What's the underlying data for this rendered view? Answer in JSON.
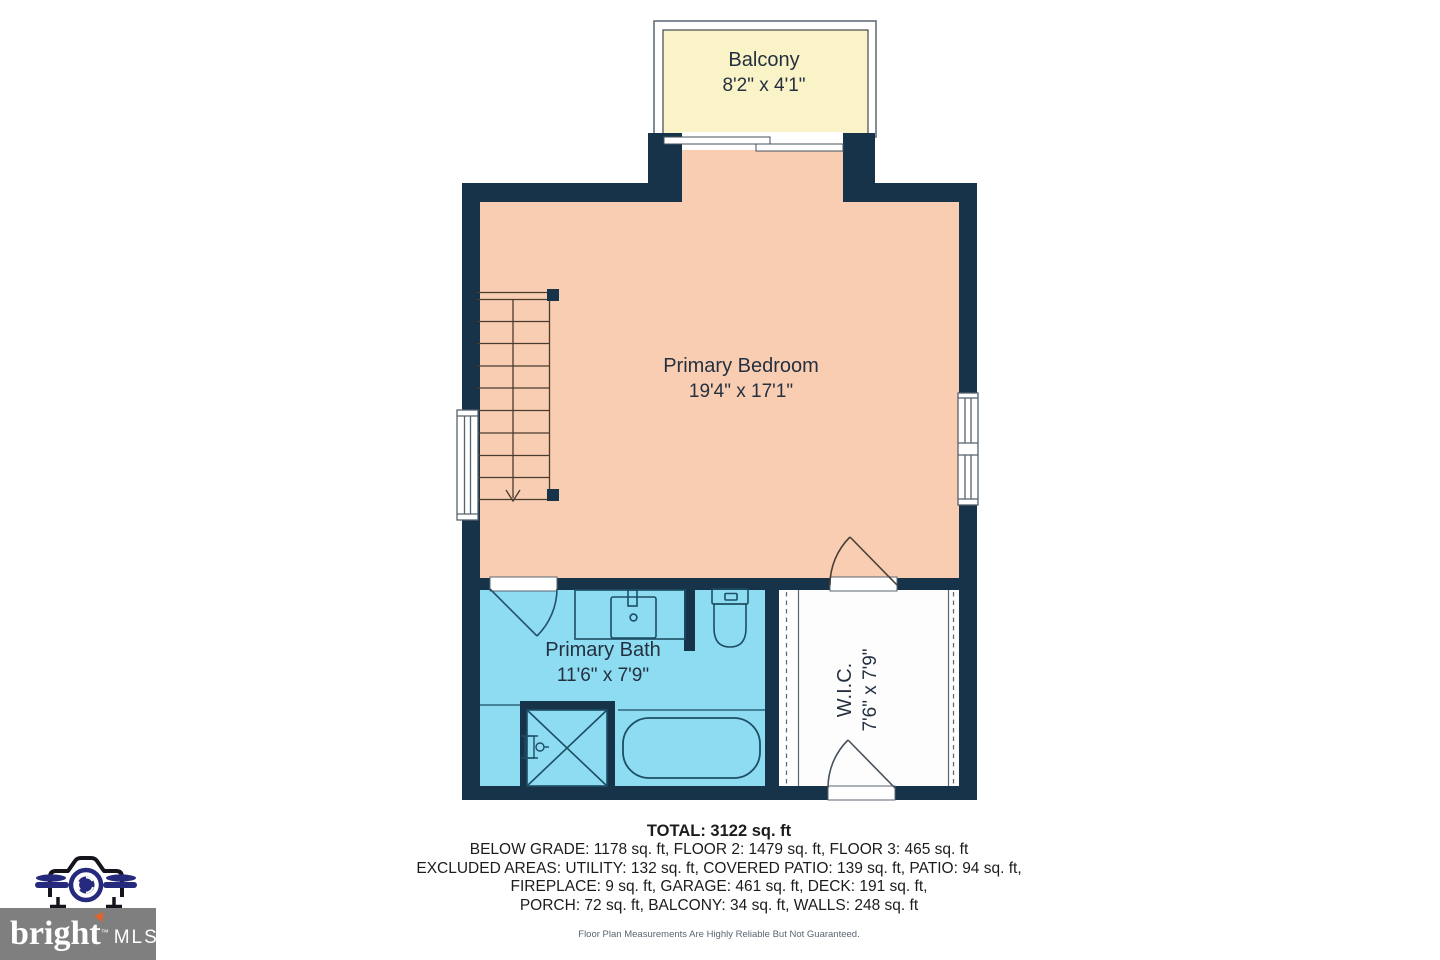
{
  "rooms": {
    "balcony": {
      "name": "Balcony",
      "dims": "8'2\" x 4'1\""
    },
    "primary_bedroom": {
      "name": "Primary Bedroom",
      "dims": "19'4\" x 17'1\""
    },
    "primary_bath": {
      "name": "Primary Bath",
      "dims": "11'6\" x 7'9\""
    },
    "wic": {
      "name": "W.I.C.",
      "dims": "7'6\" x 7'9\""
    }
  },
  "summary": {
    "total": "TOTAL: 3122 sq. ft",
    "line1": "BELOW GRADE: 1178 sq. ft, FLOOR 2: 1479 sq. ft, FLOOR 3: 465 sq. ft",
    "line2": "EXCLUDED AREAS: UTILITY: 132 sq. ft, COVERED PATIO: 139 sq. ft, PATIO: 94 sq. ft,",
    "line3": "FIREPLACE: 9 sq. ft, GARAGE: 461 sq. ft, DECK: 191 sq. ft,",
    "line4": "PORCH: 72 sq. ft, BALCONY: 34 sq. ft, WALLS: 248 sq. ft",
    "disclaimer": "Floor Plan Measurements Are Highly Reliable But Not Guaranteed."
  },
  "logo": {
    "brand": "bright",
    "tm": "™",
    "suffix": "MLS"
  },
  "colors": {
    "wall": "#16334a",
    "bedroom_fill": "#f9cdb2",
    "balcony_fill": "#faf3c8",
    "bath_fill": "#8edcf2",
    "wic_fill": "#fdfdfd",
    "logo_navy": "#252a7d",
    "logo_gray": "#7f7f7f",
    "logo_orange": "#e0622c"
  }
}
